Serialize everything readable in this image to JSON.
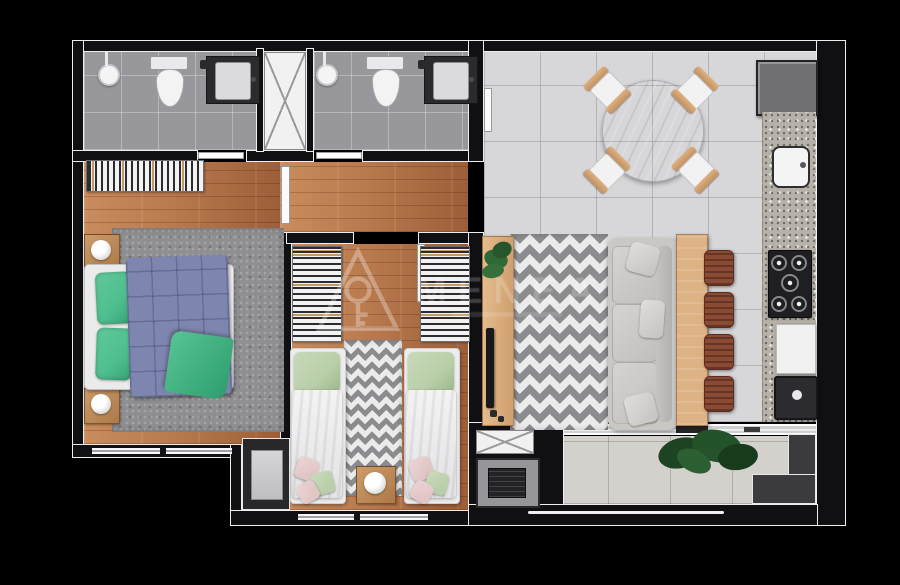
{
  "watermark": {
    "primary_text": "MENEA",
    "logo": "house-key-logo"
  },
  "palette": {
    "wall": "#101012",
    "wall_line": "#eeeeee",
    "wood": "#b97a4e",
    "wood_light": "#c98c5e",
    "wood_dark": "#9d5e38",
    "bath_tile": "#98989c",
    "living_tile": "#d7d7d9",
    "balcony_tile": "#d4d1cd",
    "shag_rug": "#8f8f91",
    "chevron_dark": "#8c8c8e",
    "chevron_light": "#ebebec",
    "duvet_blue": "#7e85ae",
    "pillow_green": "#4fbe8e",
    "pillow_sage": "#b9cfa9",
    "pillow_pink": "#e2c6c6",
    "table_wood": "#d9ac7c",
    "stool_brown": "#8b4a34",
    "sofa_gray": "#cac8c4",
    "granite": "#b6b2a9",
    "fridge": "#707073",
    "bar_wood": "#ddb284",
    "plant_green": "#27542c"
  },
  "rooms": [
    {
      "id": "bathroom-1"
    },
    {
      "id": "bathroom-2"
    },
    {
      "id": "master-bedroom"
    },
    {
      "id": "hallway"
    },
    {
      "id": "bedroom-2"
    },
    {
      "id": "living-dining"
    },
    {
      "id": "kitchen"
    },
    {
      "id": "balcony"
    }
  ],
  "items": [
    "shower",
    "toilet",
    "vanity-sink",
    "clothes-rack",
    "double-bed",
    "nightstand",
    "table-lamp",
    "single-bed",
    "wardrobe",
    "round-dining-table",
    "dining-chair",
    "fridge",
    "kitchen-sink",
    "cooktop",
    "dishwasher",
    "laundry-tub",
    "breakfast-bar",
    "bar-stool",
    "sofa",
    "chevron-rug",
    "tv-console",
    "tv",
    "potted-plant",
    "barbecue-grill",
    "balcony-bench",
    "sliding-glass-door"
  ]
}
